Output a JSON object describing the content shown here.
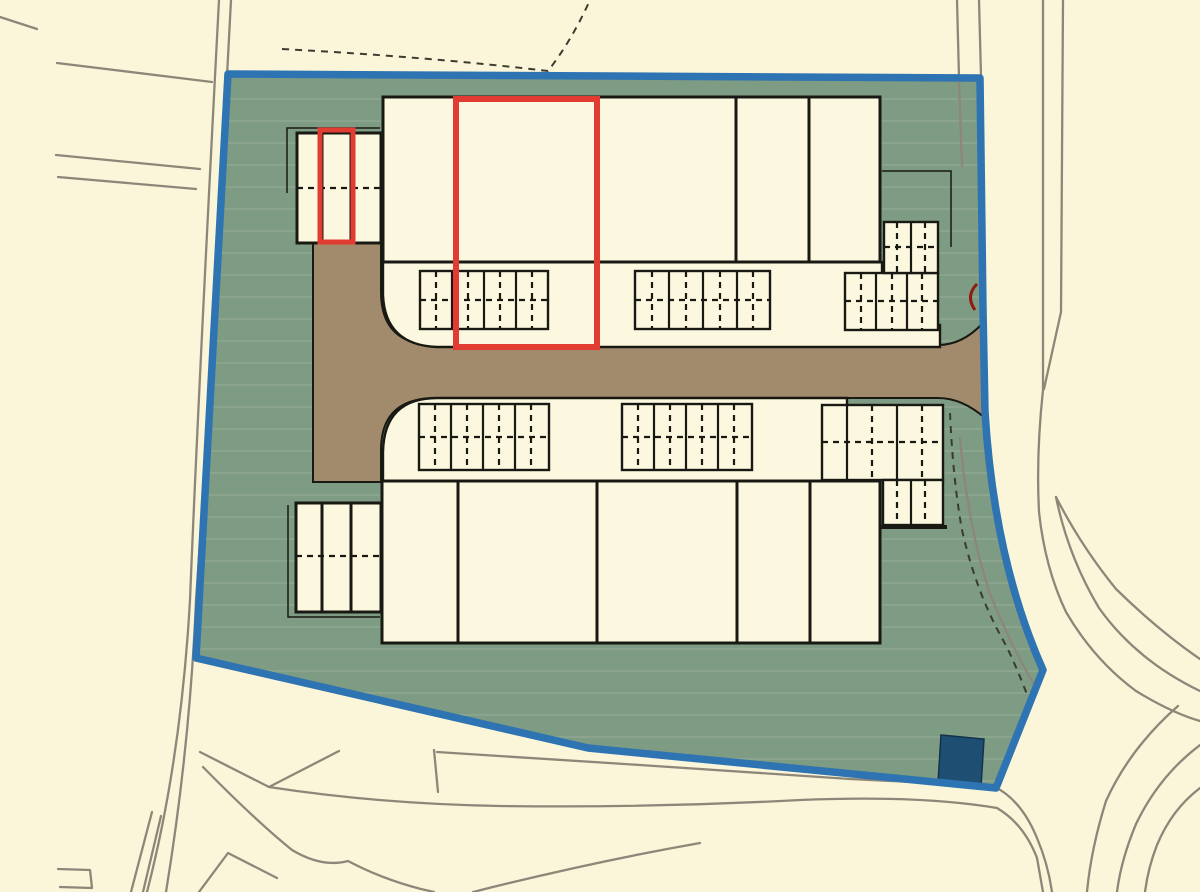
{
  "title": "Site layout plan",
  "colors": {
    "background": "#FBF6D9",
    "site_green": "#7E9B83",
    "boundary_blue": "#2E73B2",
    "road_brown": "#A28B6D",
    "building_cream": "#FCF8DF",
    "outline_black": "#191913",
    "highlight_red": "#E23B31",
    "substation_navy": "#1F4E73",
    "road_line_grey": "#8D8779",
    "field_line_dark": "#3B3B30",
    "dark_red_arc": "#8F1B12"
  },
  "plan": {
    "site_boundary": "blue site boundary",
    "site_area": "green application site",
    "access_road": "brown access road (T-shape, exits east)",
    "north_terrace_units": 5,
    "south_terrace_units": 5,
    "garage_blocks": 2,
    "parking_bay_groups": 8,
    "highlighted_unit": "red outlined unit in north terrace",
    "highlighted_garage": "red outlined garage in north-west garage block",
    "substation": "dark blue substation block, south-east corner"
  }
}
